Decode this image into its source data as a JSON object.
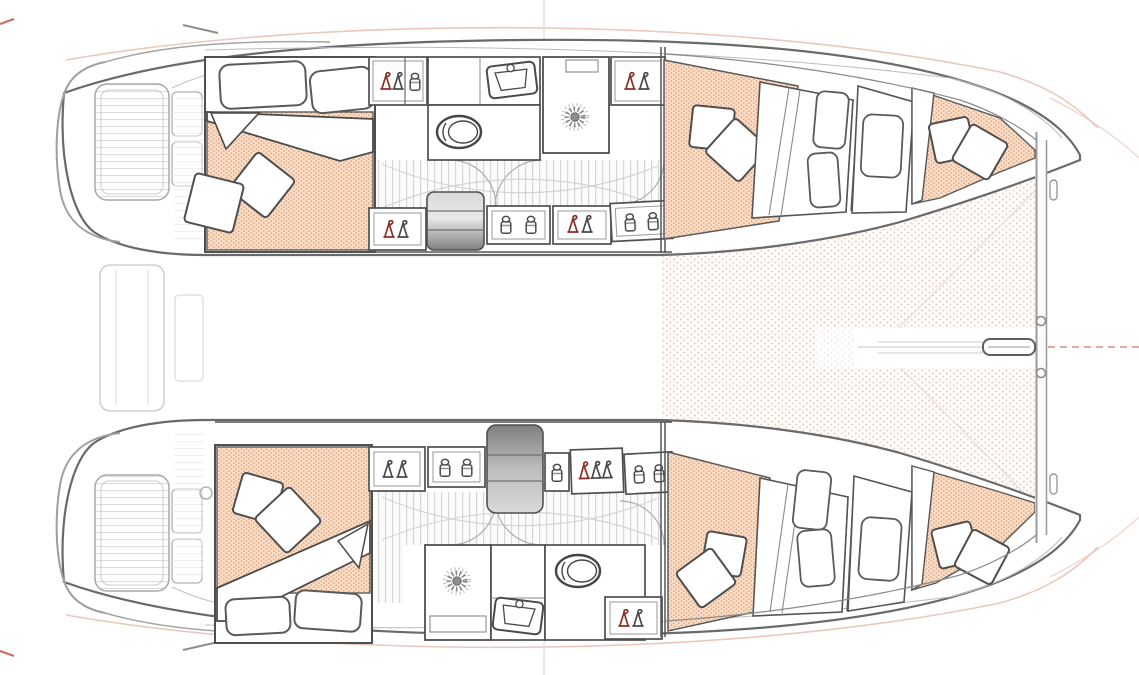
{
  "meta": {
    "title": "Catamaran accommodation floor plan",
    "view": "top-down"
  },
  "colors": {
    "paper": "#ffffff",
    "outline_dark": "#4a4a4a",
    "outline_medium": "#8f8f8f",
    "outline_faint": "#c0c0c0",
    "mattress_base": "#f9dcc3",
    "mattress_dot": "#e19a71",
    "trampoline_dot": "#e8c7b8",
    "floor_stripe": "#d6d6d6",
    "deck_stripe": "#dcdcdc",
    "steps_dark": "#7f7f7f",
    "steps_light": "#d9d9d9",
    "accent_red": "#8e2f23",
    "sheer_accent": "#e9c2b2",
    "guide_red": "#c96a5c"
  },
  "diagram": {
    "vessel_type": "catamaran",
    "hulls": [
      {
        "id": "port",
        "position": "top",
        "spaces": [
          "aft-double-cabin",
          "wardrobe-lockers",
          "sink-unit",
          "shower-room",
          "toilet-room",
          "corridor",
          "companionway-steps",
          "forward-double-cabin",
          "forward-single-berths",
          "forepeak-berth"
        ]
      },
      {
        "id": "starboard",
        "position": "bottom",
        "spaces": [
          "aft-double-cabin",
          "wardrobe-lockers",
          "shower-room",
          "vanity-sink",
          "toilet-room",
          "corridor",
          "companionway-steps",
          "forward-double-cabin",
          "forward-single-berths",
          "forepeak-berth"
        ]
      }
    ],
    "shared_elements": [
      "stern-platforms",
      "swim-steps",
      "aft-crossbar",
      "bow-trampoline",
      "forward-crossbeam",
      "bowsprit",
      "forestay-bridle"
    ],
    "fixture_counts": {
      "double_berth_cabins": 4,
      "single_berths": 4,
      "forepeak_berths": 2,
      "toilets": 2,
      "showers": 2,
      "sinks": 2,
      "companionway_steps": 2,
      "wardrobe_lockers": 7,
      "storage_lockers": 6
    }
  },
  "icons": {
    "hanger": "clothes-hanger",
    "jar": "storage-jar",
    "sunburst": "shower-drain",
    "toilet": "marine-toilet",
    "sink": "washbasin",
    "bowsprit": "bowsprit-fitting"
  }
}
